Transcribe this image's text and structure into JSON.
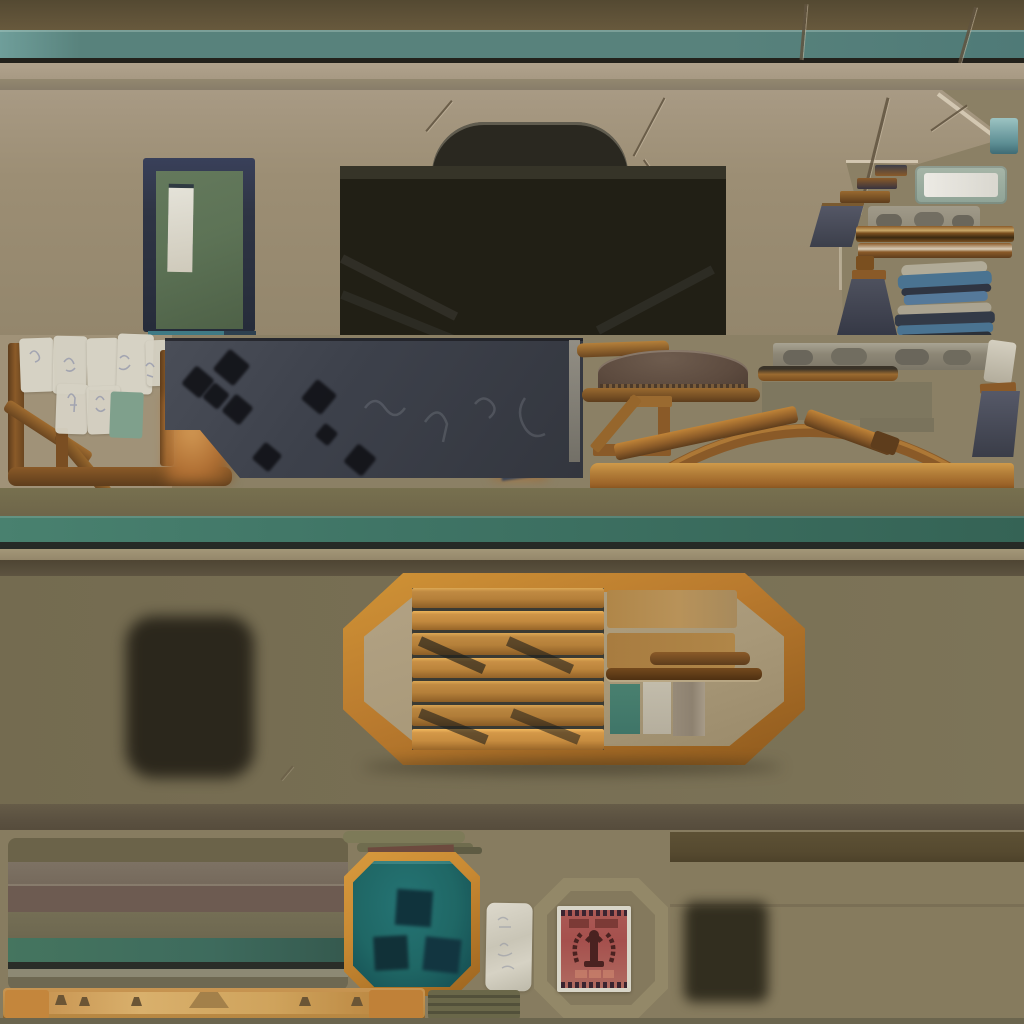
{
  "meta": {
    "kind": "hand-painted game environment texture atlas",
    "canvas": {
      "width": 1024,
      "height": 1024
    },
    "visible_text": "none"
  },
  "palette": {
    "beamDark": "#5e5238",
    "tealTop": "#58827c",
    "inkLine": "#23211b",
    "tanLight": "#a79983",
    "tanMid": "#93886f",
    "wallTan": "#9c8e74",
    "wallTanLight": "#a89a84",
    "flatBg": "#8b8065",
    "doorNavy": "#2f3545",
    "doorGreen": "#5d7356",
    "doorWin": "#dcdacf",
    "openDark": "#211f15",
    "openTop": "#363428",
    "slate": "#3d414b",
    "holeBlack": "#121318",
    "woodDark": "#6b4620",
    "woodMid": "#8a5a28",
    "woodLight": "#c08438",
    "woodPale": "#d8ad6a",
    "dome": "#5d4b3f",
    "stone": "#8d8776",
    "stoneBlob": "#6a665b",
    "navy": "#474a58",
    "clothBlue": "#4a7391",
    "clothDark": "#2f3542",
    "clothLight": "#b1ab98",
    "tealGreen": "#3f7465",
    "midWall": "#786f54",
    "bandBrown": "#5a5040",
    "frameOrange": "#b97a2e",
    "frameInner": "#a89878",
    "plank": "#b5803a",
    "plankGap": "#3a3a33",
    "swTeal": "#3f7568",
    "swGray": "#b5ae9d",
    "swTaupe": "#8d8170",
    "panelTeal": "#1f6765",
    "panelTealDark": "#144b50",
    "panelFrame": "#c98a33",
    "posterRed": "#a5504d",
    "posterInk": "#4a2220",
    "posterPaper": "#d8d5c8",
    "paper": "#d6d2c4",
    "noteTeal": "#7fa08c",
    "blob": "#262218",
    "bottomBg": "#877c60",
    "rightPanelTop": "#55492f",
    "rightPanel": "#867b5e",
    "oliveBar": "#5f5c42",
    "pegWood": "#c89552",
    "pegWoodLight": "#d9b06c",
    "pegDark": "#6b5535",
    "tealDoorStep": "#3f7a85"
  },
  "atlas": {
    "regions": [
      {
        "name": "trim-beam-with-teal-stripe"
      },
      {
        "name": "stucco-wall-with-green-door-and-garage-opening"
      },
      {
        "name": "cracked-plaster-corner"
      },
      {
        "name": "small-props-steps-beams-sign-cloth"
      },
      {
        "name": "notice-papers-and-wood-railing"
      },
      {
        "name": "chalkboard-with-bullet-holes"
      },
      {
        "name": "awning-dome-and-roof-truss"
      },
      {
        "name": "stone-block-strip"
      },
      {
        "name": "teal-stripe-wainscot-beam"
      },
      {
        "name": "olive-wall-with-octagonal-crate-frame"
      },
      {
        "name": "shadow-decals"
      },
      {
        "name": "striped-wall-panel-tile"
      },
      {
        "name": "teal-octagon-hatch-panel"
      },
      {
        "name": "red-propaganda-poster-in-octagon-frame"
      },
      {
        "name": "peg-rail-plank"
      }
    ]
  }
}
